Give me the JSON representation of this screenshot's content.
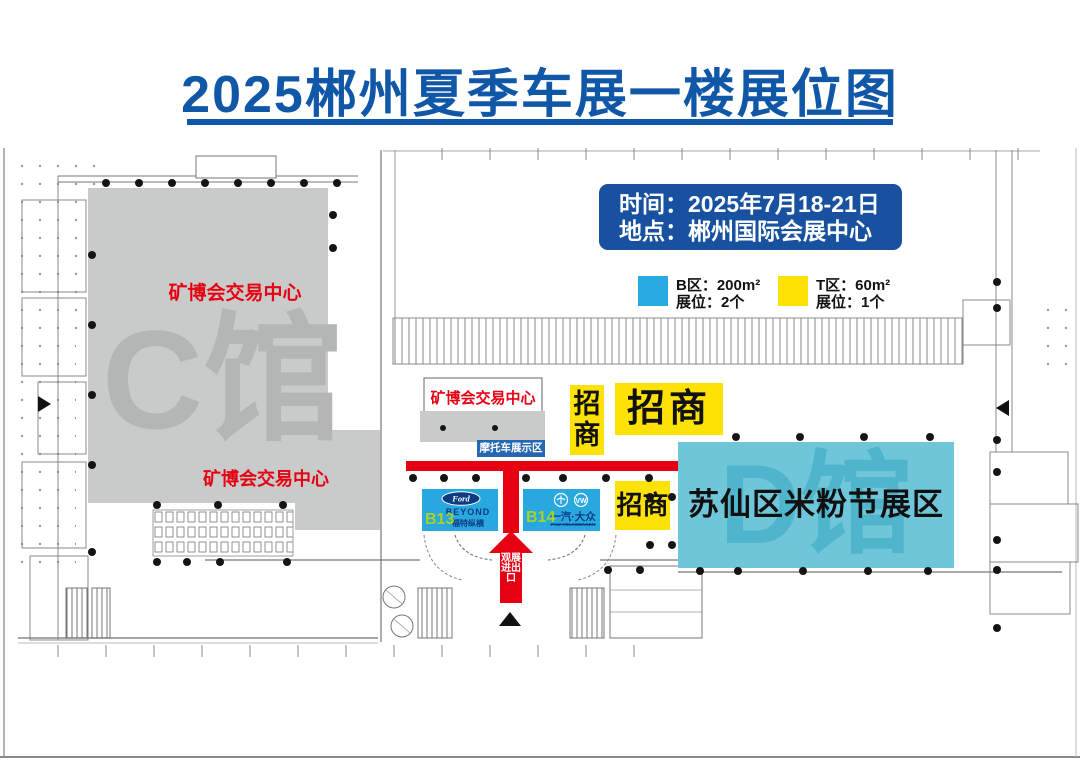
{
  "title": {
    "text": "2025郴州夏季车展一楼展位图"
  },
  "info_box": {
    "time_line": "时间：2025年7月18-21日",
    "location_line": "地点：郴州国际会展中心"
  },
  "legend": {
    "b": {
      "zone": "B区：200m²",
      "booths": "展位：2个",
      "color": "#29ABE2"
    },
    "t": {
      "zone": "T区：60m²",
      "booths": "展位：1个",
      "color": "#FFE205"
    }
  },
  "halls": {
    "c": {
      "watermark": "C馆",
      "label_top": "矿博会交易中心",
      "label_bottom": "矿博会交易中心"
    },
    "d": {
      "watermark": "D馆",
      "label": "苏仙区米粉节展区"
    }
  },
  "zones": {
    "moto_area": {
      "hall_label": "矿博会交易中心",
      "label": "摩托车展示区"
    },
    "zhaoshang_vertical": "招商",
    "zhaoshang_large": "招商",
    "zhaoshang_small": "招商",
    "entrance_arrow": "观展进出口"
  },
  "booths": {
    "b13": {
      "id": "B13",
      "logo": "Ford",
      "brand": "BEYOND",
      "brand_cn": "福特纵横"
    },
    "b14": {
      "id": "B14",
      "brand": "一汽·大众",
      "brand_en": "FAW-VOLKSWAGEN"
    }
  },
  "colors": {
    "title_blue": "#1157A8",
    "info_box_blue": "#17519F",
    "legend_blue": "#29ABE2",
    "zone_yellow": "#FFE205",
    "corridor_red": "#E60012",
    "hall_gray": "#C9CACA",
    "hall_watermark_gray": "#B4B5B5",
    "d_zone_cyan": "#70C6D9",
    "d_watermark_cyan": "#4EB5CD",
    "booth_blue": "#29A7DF",
    "booth_id_green": "#A8D325",
    "brand_navy": "#0C3C82",
    "moto_label_blue": "#2766B0"
  }
}
